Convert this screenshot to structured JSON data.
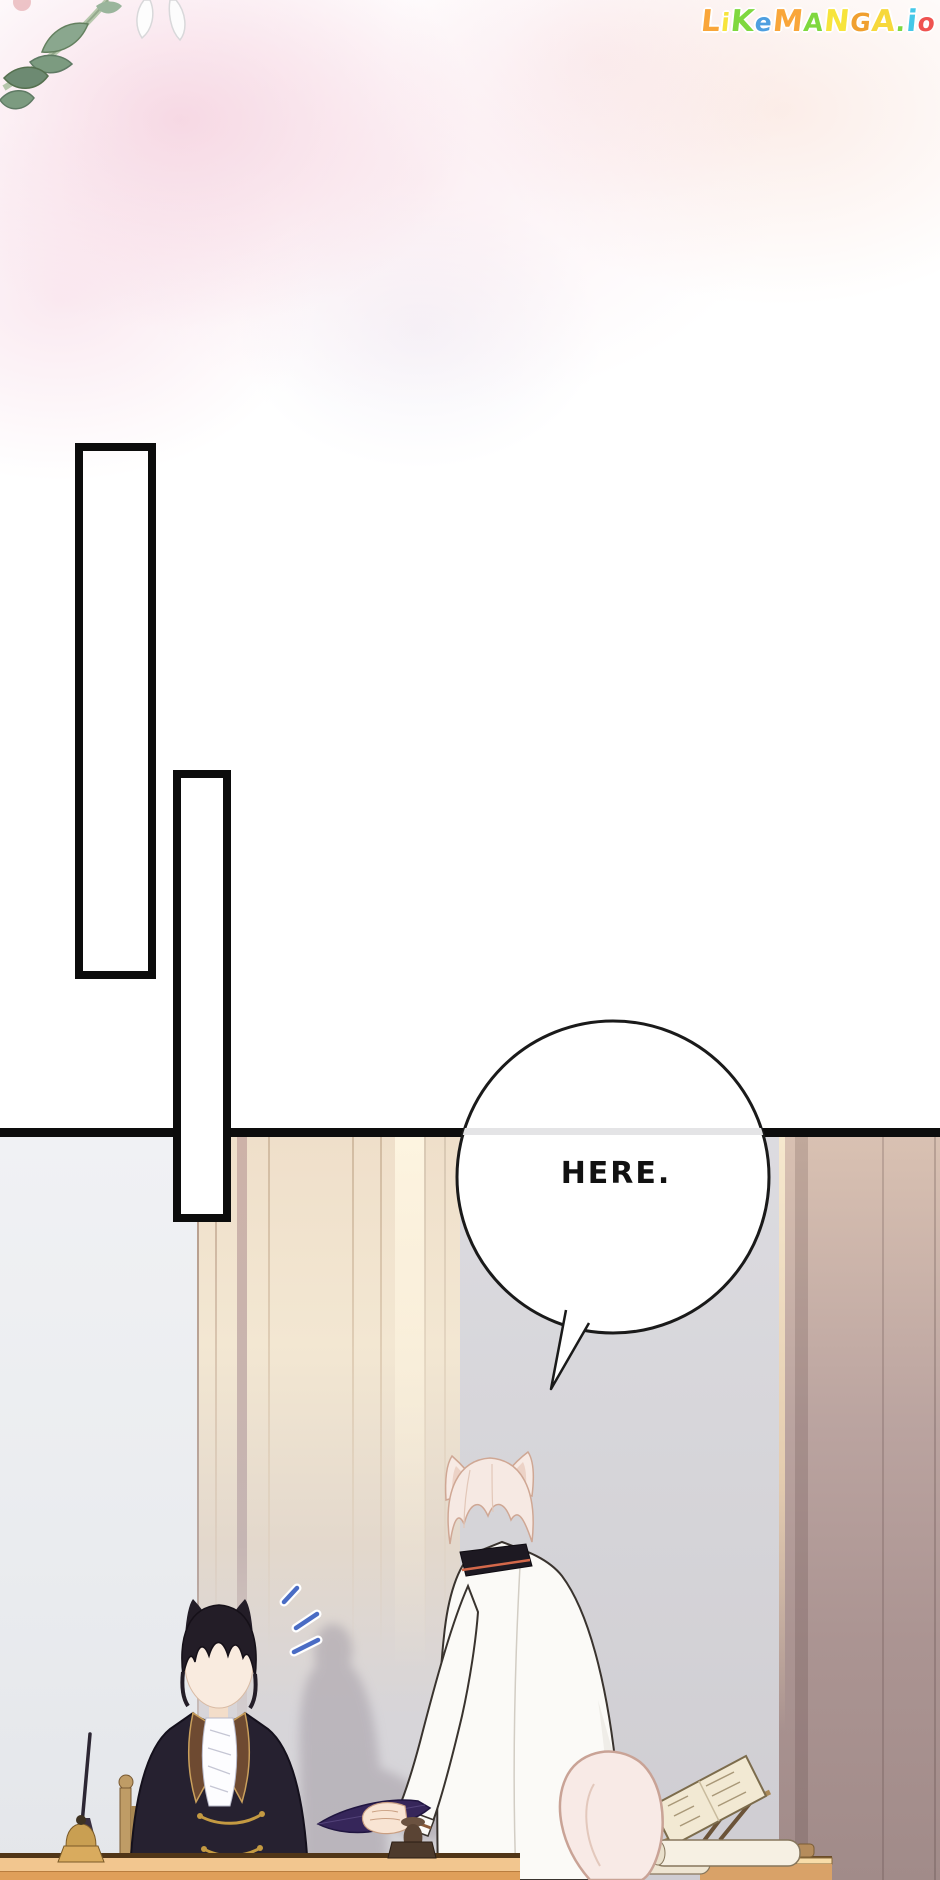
{
  "watermark": {
    "text": "LiKeMANGA.io",
    "letters": [
      {
        "ch": "L",
        "color": "#f9a63a"
      },
      {
        "ch": "i",
        "color": "#f7e43c"
      },
      {
        "ch": "K",
        "color": "#7fd83f"
      },
      {
        "ch": "e",
        "color": "#4e9fe0"
      },
      {
        "ch": "M",
        "color": "#f9a63a"
      },
      {
        "ch": "A",
        "color": "#7fd83f"
      },
      {
        "ch": "N",
        "color": "#f7e43c"
      },
      {
        "ch": "G",
        "color": "#f0a030"
      },
      {
        "ch": "A",
        "color": "#f7d83c"
      },
      {
        "ch": ".",
        "color": "#7fd83f"
      },
      {
        "ch": "i",
        "color": "#45c8e8"
      },
      {
        "ch": "o",
        "color": "#ef5350"
      }
    ]
  },
  "speech_bubble": {
    "text": "HERE."
  },
  "palette": {
    "panel_border": "#0d0d0d",
    "left_wall_grey": "#eceef2",
    "center_wall_grey": "#d8d7db",
    "door_cream": "#f4e8d4",
    "right_wall_mauve": "#ab9496",
    "desk_wood": "#f2c68f",
    "surprise_marks_blue": "#4a6cc4",
    "tail_pink": "#f8eae6",
    "jacket_white": "#fbfaf7",
    "suit_black": "#262130",
    "quill_purple": "#36265a"
  }
}
